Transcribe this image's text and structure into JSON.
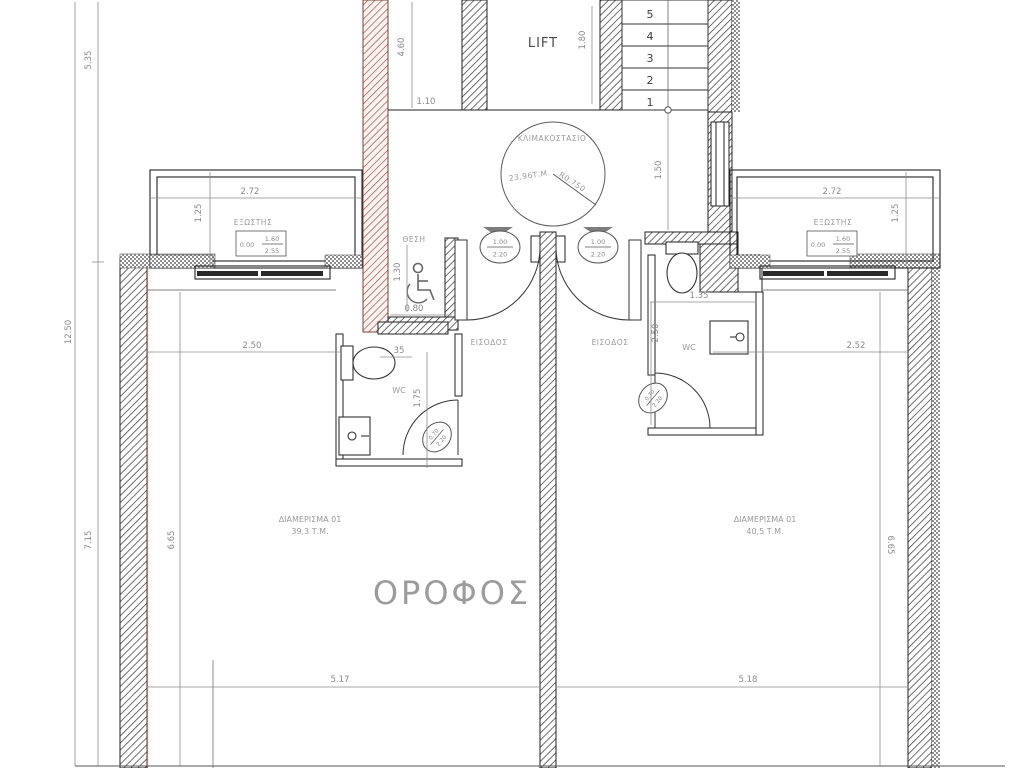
{
  "plan": {
    "floor_title": "ΟΡΟΦΟΣ",
    "core": {
      "lift": "LIFT",
      "stair_steps": [
        "5",
        "4",
        "3",
        "2",
        "1"
      ],
      "stairwell_name": "ΚΛΙΜΑΚΟΣΤΑΣΙΟ",
      "stairwell_area": "23,96Τ.Μ.",
      "stairwell_radius": "R0.750",
      "dim_core_height": "4.60",
      "dim_core_width": "1.10",
      "dim_lift": "1.80",
      "dim_landing": "1.50"
    },
    "left_dims": {
      "total": "12.50",
      "top": "5.35",
      "bottom": "7.15"
    },
    "accessible": {
      "label": "ΘΕΣΗ",
      "dim_depth": "1.30",
      "dim_width": "0.80"
    },
    "entrance_left": {
      "label": "ΕΙΣΟΔΟΣ",
      "door_width": "1.00",
      "door_height": "2.20"
    },
    "entrance_right": {
      "label": "ΕΙΣΟΔΟΣ",
      "door_width": "1.00",
      "door_height": "2.20"
    },
    "balcony_left": {
      "label": "ΕΞΩΣΤΗΣ",
      "dim_width": "2.72",
      "dim_depth": "1.25",
      "win_sill": "0.00",
      "win_top": "1.60",
      "win_bottom": "2.55"
    },
    "balcony_right": {
      "label": "ΕΞΩΣΤΗΣ",
      "dim_width": "2.72",
      "dim_depth": "1.25",
      "win_sill": "0.00",
      "win_top": "1.60",
      "win_bottom": "2.55"
    },
    "wc_left": {
      "label": "WC",
      "dim_a": "35",
      "dim_b": "1.75",
      "door_width": "0.70",
      "door_height": "2.20"
    },
    "wc_right": {
      "label": "WC",
      "dim_a": "1.35",
      "dim_b": "2.50",
      "door_width": "0.70",
      "door_height": "2.20"
    },
    "apt_left": {
      "name": "ΔΙΑΜΕΡΙΣΜΑ 01",
      "area": "39,3 Τ.Μ.",
      "dim_top": "2.50",
      "dim_side": "6.65",
      "dim_bottom": "5.17"
    },
    "apt_right": {
      "name": "ΔΙΑΜΕΡΙΣΜΑ 01",
      "area": "40,5 Τ.Μ.",
      "dim_top": "2.52",
      "dim_side": "6.65",
      "dim_bottom": "5.18"
    }
  }
}
